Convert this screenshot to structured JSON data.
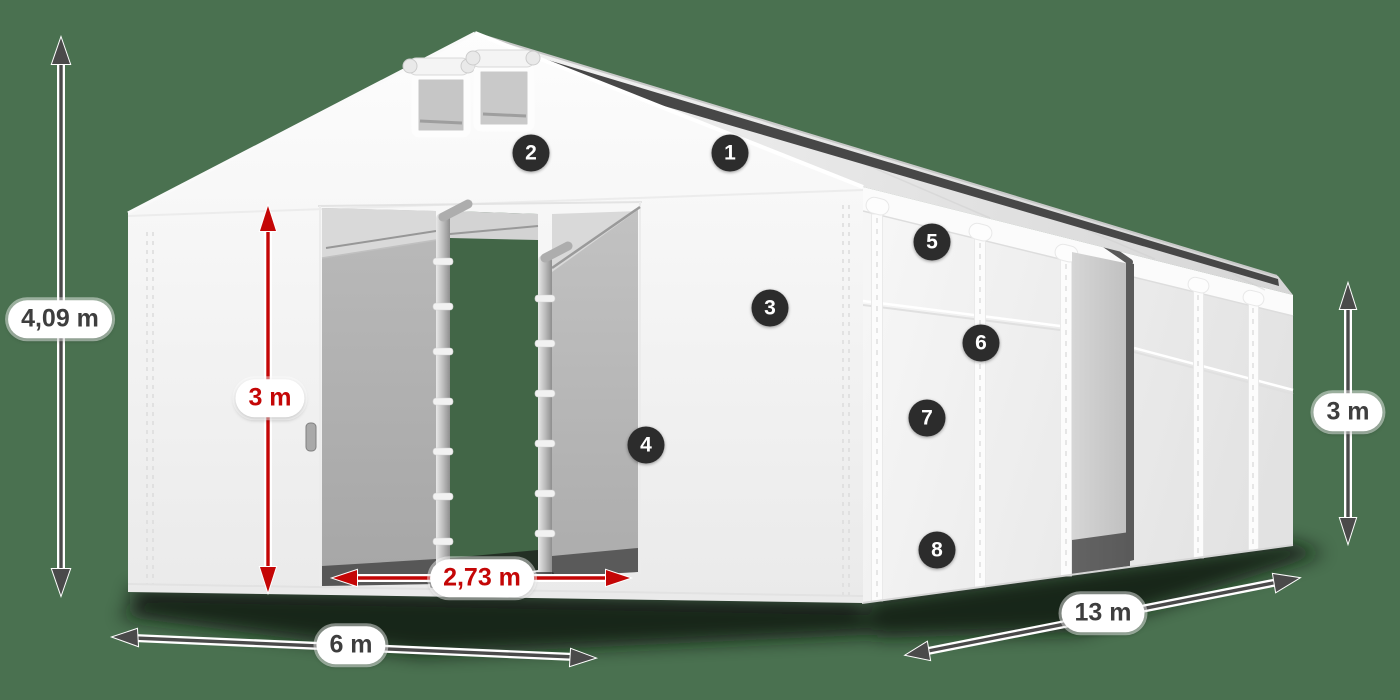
{
  "diagram": {
    "type": "tent-dimension-diagram",
    "background_color": "#4a7150",
    "badge_color": "#2c2c2c",
    "arrow_dark_color": "#4a4a4a",
    "arrow_red_color": "#c40606",
    "tent_color": "#f5f5f5"
  },
  "dimensions": {
    "total_height": "4,09 m",
    "entrance_height": "3 m",
    "entrance_width": "2,73 m",
    "side_wall_height": "3 m",
    "width": "6 m",
    "length": "13 m"
  },
  "callouts": [
    {
      "number": "1"
    },
    {
      "number": "2"
    },
    {
      "number": "3"
    },
    {
      "number": "4"
    },
    {
      "number": "5"
    },
    {
      "number": "6"
    },
    {
      "number": "7"
    },
    {
      "number": "8"
    }
  ]
}
